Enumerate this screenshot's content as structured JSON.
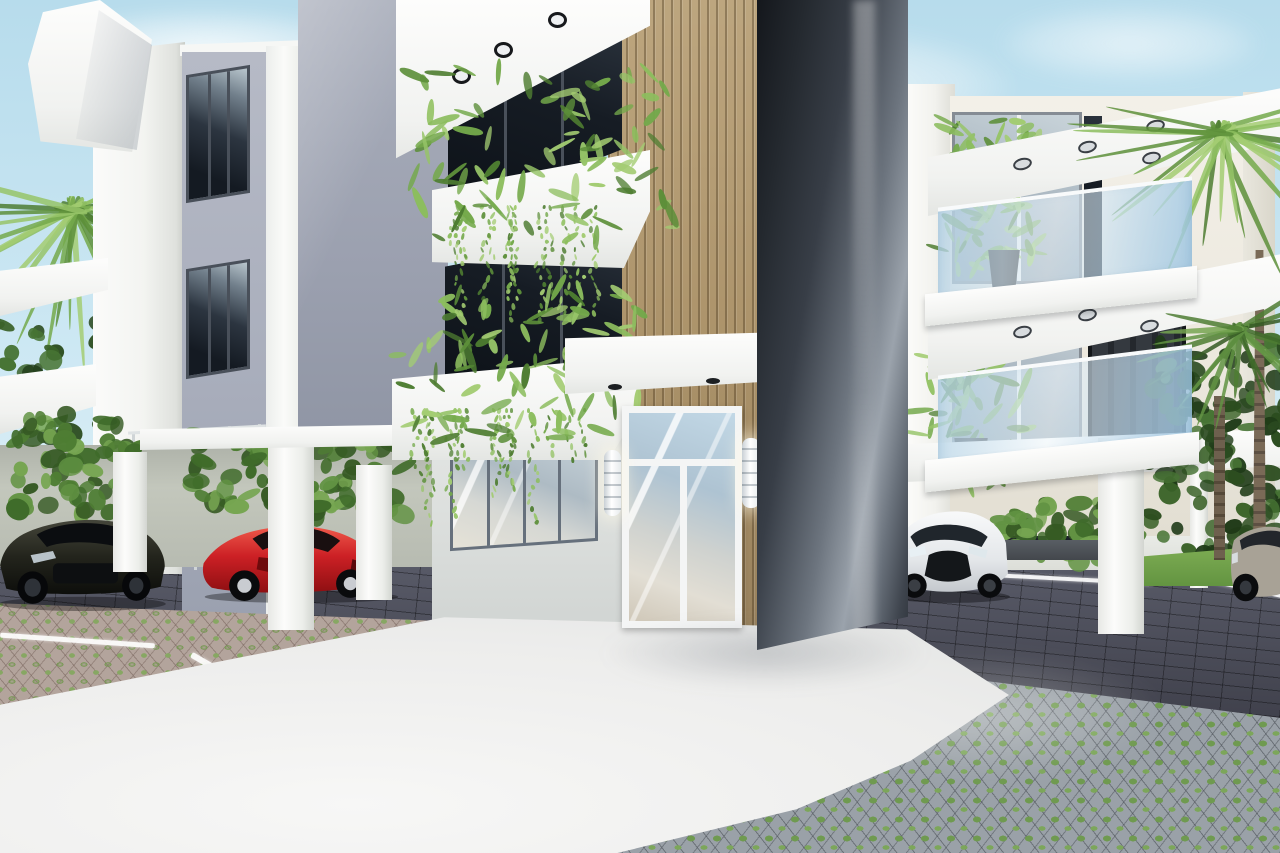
{
  "meta": {
    "type": "3d-architectural-rendering",
    "subject": "Modern three-story tropical apartment complex exterior with carports, parked cars and landscaped parking area",
    "visible_text": "none"
  },
  "palette": {
    "sky_top": "#b7dcec",
    "sky_bottom": "#e8f3f7",
    "white_wall": "#f5f5f2",
    "cream_wall": "#efece4",
    "gray_facade": "#a8adbb",
    "gray_facade_shadow": "#8f95a4",
    "wood_slat": "#b29a74",
    "wood_slat_shadow": "#97805c",
    "tower_dark": "#1c2026",
    "tower_highlight": "#9ba3ac",
    "glass_dark": "#12171d",
    "glass_reflective": "#bccbd4",
    "balustrade_glass": "#cfe4f0",
    "paver_dark": "#4a4b58",
    "paver_gray": "#9aa1a8",
    "paver_pink": "#b3a49c",
    "grass_green": "#6f9a50",
    "lawn_green": "#74a04a",
    "foliage_dark": "#2c4d1f",
    "foliage_light": "#7fb24e",
    "walkway_white": "#ededec",
    "car_dark": "#2b2c24",
    "car_red": "#c8232a",
    "car_white": "#eef0f2",
    "car_silver": "#a09a90"
  },
  "labels": {
    "scene": "Architectural rendering of a modern apartment complex with tropical landscaping",
    "sky": "Clear pale-blue sky with soft clouds",
    "left_building": "Left apartment block with gray facade, white corner pillar and balconies",
    "center_building": "Central block with wood-slat entrance facade and planted balconies",
    "dark_tower": "Dark glossy feature tower",
    "wood_facade": "Vertical wood slat cladding",
    "entrance_door": "White-framed glass entrance door",
    "sconces": "Cylindrical wall lights flanking the entrance",
    "balcony_plants": "Balcony planters with ferns and trailing vines",
    "right_building": "Right apartment block with glass balconies and carport",
    "carport_left": "Left carport with parked cars",
    "carport_right": "Right carport with parked white sedan",
    "dark_sedan": "Dark sport sedan",
    "red_sports_car": "Red sports car",
    "white_sedan": "White sedan",
    "silver_car": "Silver car at right edge",
    "walkway": "White concrete walkway",
    "dark_pavers": "Dark brick paver driveway",
    "grass_pavers": "Permeable grass-grid pavers",
    "parking_lines": "White parking lane lines",
    "palms": "Palm trees",
    "hedges": "Hedges and tropical shrubs",
    "lawn": "Lawn strip",
    "boundary_wall": "Light boundary wall behind carport"
  }
}
